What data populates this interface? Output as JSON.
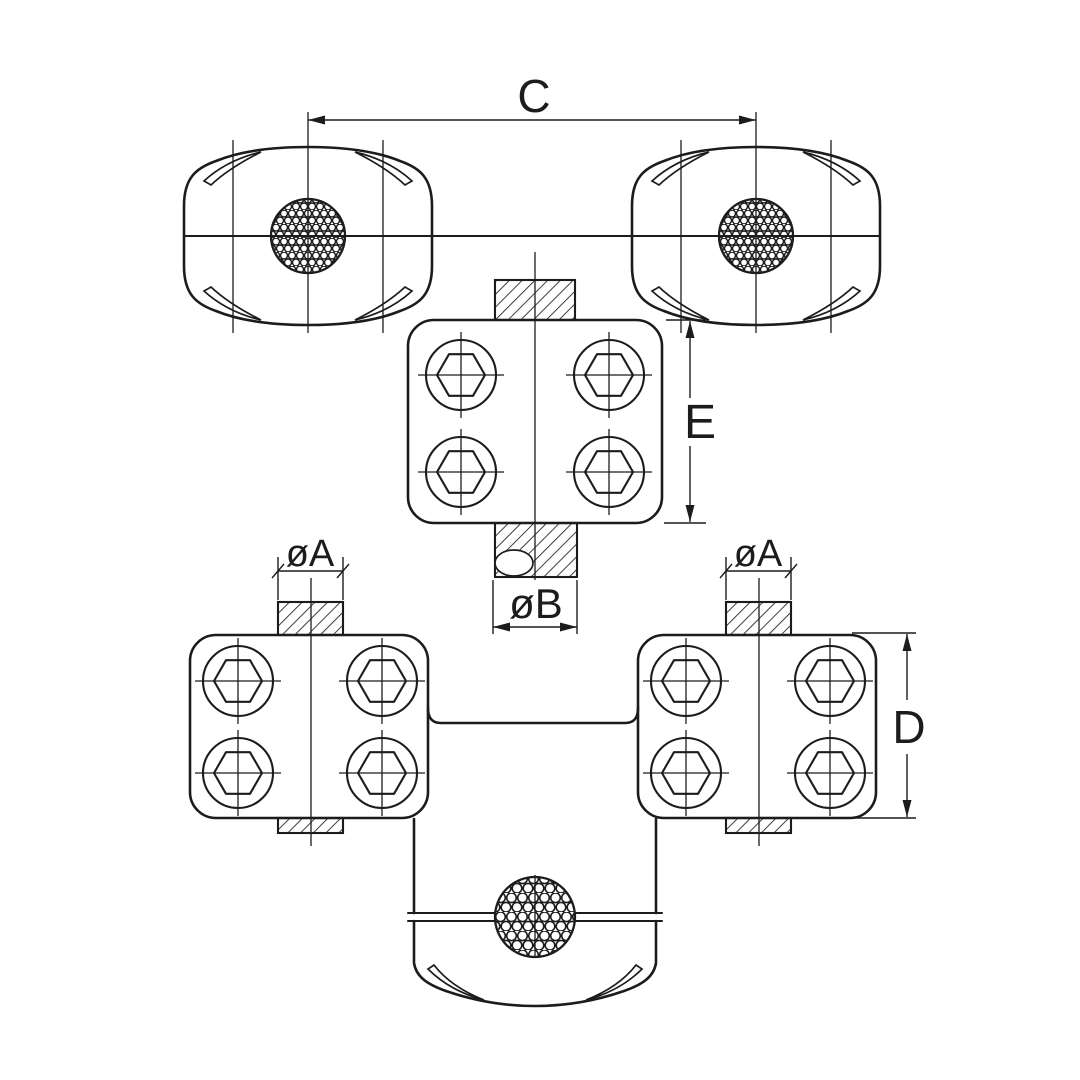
{
  "drawing": {
    "background_color": "#ffffff",
    "line_color": "#1c1c1c",
    "dimension_labels": {
      "c": "C",
      "e": "E",
      "d": "D",
      "oa_left": "øA",
      "oa_right": "øA",
      "ob": "øB"
    }
  }
}
